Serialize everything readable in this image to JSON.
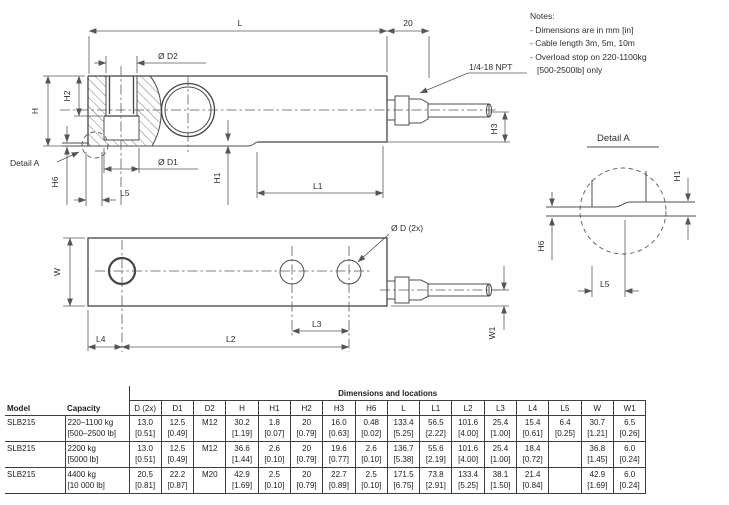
{
  "notes": {
    "title": "Notes:",
    "lines": [
      "- Dimensions are in mm [in]",
      "- Cable length 3m, 5m, 10m",
      "- Overload stop on 220-1100kg",
      "[500-2500lb] only"
    ]
  },
  "drawing": {
    "side": {
      "L": "L",
      "twenty": "20",
      "d2": "Ø D2",
      "npt": "1/4-18 NPT",
      "h": "H",
      "h2": "H2",
      "h6": "H6",
      "l5": "L5",
      "d1": "Ø D1",
      "h1": "H1",
      "l1": "L1",
      "h3": "H3",
      "detail_ref": "Detail A"
    },
    "top": {
      "d": "Ø D (2x)",
      "w": "W",
      "w1": "W1",
      "l2": "L2",
      "l3": "L3",
      "l4": "L4"
    },
    "detail": {
      "title": "Detail A",
      "h1": "H1",
      "h6": "H6",
      "l5": "L5"
    }
  },
  "table": {
    "span_header": "Dimensions and locations",
    "columns": [
      "Model",
      "Capacity",
      "D (2x)",
      "D1",
      "D2",
      "H",
      "H1",
      "H2",
      "H3",
      "H6",
      "L",
      "L1",
      "L2",
      "L3",
      "L4",
      "L5",
      "W",
      "W1"
    ],
    "rows": [
      {
        "model": "SLB215",
        "capacity_metric": "220–1100 kg",
        "capacity_imperial": "[500–2500 lb]",
        "values": [
          [
            "13.0",
            "[0.51]"
          ],
          [
            "12.5",
            "[0.49]"
          ],
          [
            "M12",
            ""
          ],
          [
            "30.2",
            "[1.19]"
          ],
          [
            "1.8",
            "[0.07]"
          ],
          [
            "20",
            "[0.79]"
          ],
          [
            "16.0",
            "[0.63]"
          ],
          [
            "0.48",
            "[0.02]"
          ],
          [
            "133.4",
            "[5.25]"
          ],
          [
            "56.5",
            "[2.22]"
          ],
          [
            "101.6",
            "[4.00]"
          ],
          [
            "25.4",
            "[1.00]"
          ],
          [
            "15.4",
            "[0.61]"
          ],
          [
            "6.4",
            "[0.25]"
          ],
          [
            "30.7",
            "[1.21]"
          ],
          [
            "6.5",
            "[0.26]"
          ]
        ]
      },
      {
        "model": "SLB215",
        "capacity_metric": "2200 kg",
        "capacity_imperial": "[5000 lb]",
        "values": [
          [
            "13.0",
            "[0.51]"
          ],
          [
            "12.5",
            "[0.49]"
          ],
          [
            "M12",
            ""
          ],
          [
            "36.6",
            "[1.44]"
          ],
          [
            "2.6",
            "[0.10]"
          ],
          [
            "20",
            "[0.79]"
          ],
          [
            "19.6",
            "[0.77]"
          ],
          [
            "2.6",
            "[0.10]"
          ],
          [
            "136.7",
            "[5.38]"
          ],
          [
            "55.6",
            "[2.19]"
          ],
          [
            "101.6",
            "[4.00]"
          ],
          [
            "25.4",
            "[1.00]"
          ],
          [
            "18.4",
            "[0.72]"
          ],
          [
            "",
            ""
          ],
          [
            "36.8",
            "[1.45]"
          ],
          [
            "6.0",
            "[0.24]"
          ]
        ]
      },
      {
        "model": "SLB215",
        "capacity_metric": "4400 kg",
        "capacity_imperial": "[10 000 lb]",
        "values": [
          [
            "20.5",
            "[0.81]"
          ],
          [
            "22.2",
            "[0.87]"
          ],
          [
            "M20",
            ""
          ],
          [
            "42.9",
            "[1.69]"
          ],
          [
            "2.5",
            "[0.10]"
          ],
          [
            "20",
            "[0.79]"
          ],
          [
            "22.7",
            "[0.89]"
          ],
          [
            "2.5",
            "[0.10]"
          ],
          [
            "171.5",
            "[6.75]"
          ],
          [
            "73.8",
            "[2.91]"
          ],
          [
            "133.4",
            "[5.25]"
          ],
          [
            "38.1",
            "[1.50]"
          ],
          [
            "21.4",
            "[0.84]"
          ],
          [
            "",
            ""
          ],
          [
            "42.9",
            "[1.69]"
          ],
          [
            "6.0",
            "[0.24]"
          ]
        ]
      }
    ]
  },
  "colors": {
    "line": "#4a4a4a",
    "text": "#2e2e2e",
    "table_border": "#3d3d3d",
    "background": "#ffffff"
  }
}
